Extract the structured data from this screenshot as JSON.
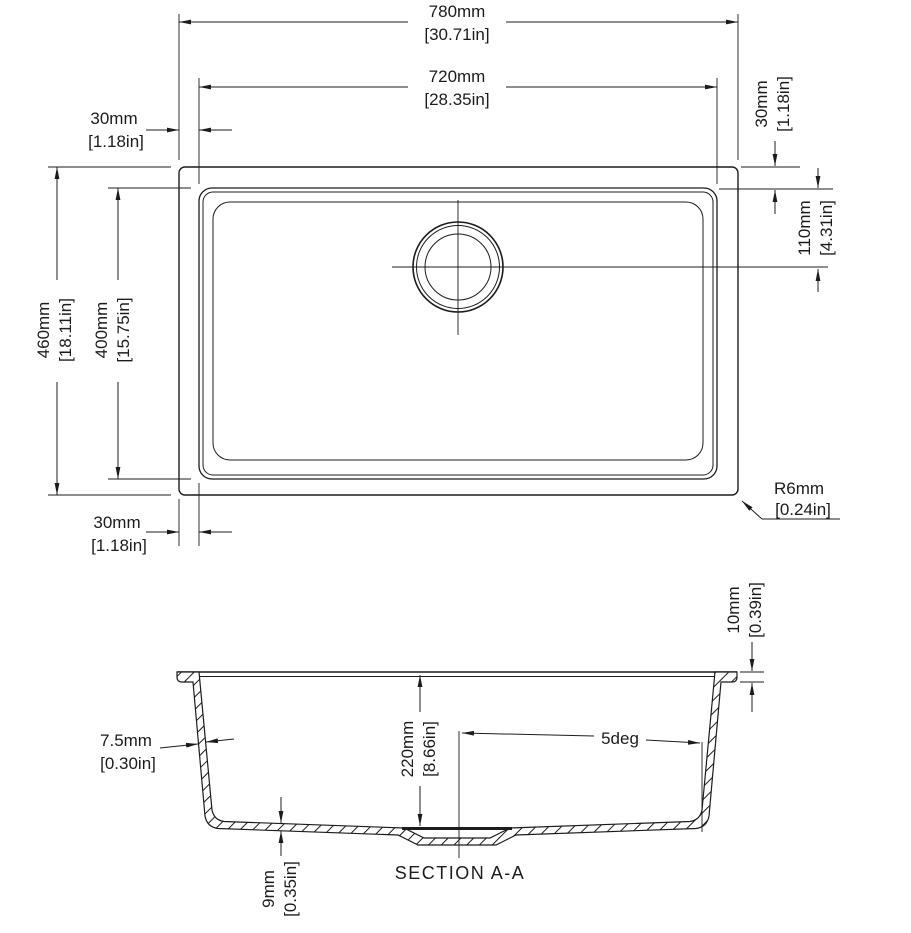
{
  "top_view": {
    "overall_width": {
      "mm": "780mm",
      "in": "[30.71in]"
    },
    "inner_width": {
      "mm": "720mm",
      "in": "[28.35in]"
    },
    "left_offset_top": {
      "mm": "30mm",
      "in": "[1.18in]"
    },
    "right_offset": {
      "mm": "30mm",
      "in": "[1.18in]"
    },
    "drain_offset": {
      "mm": "110mm",
      "in": "[4.31in]"
    },
    "overall_height": {
      "mm": "460mm",
      "in": "[18.11in]"
    },
    "inner_height": {
      "mm": "400mm",
      "in": "[15.75in]"
    },
    "left_offset_bottom": {
      "mm": "30mm",
      "in": "[1.18in]"
    },
    "corner_radius": {
      "mm": "R6mm",
      "in": "[0.24in]"
    }
  },
  "section_view": {
    "label": "SECTION A-A",
    "rim_height": {
      "mm": "10mm",
      "in": "[0.39in]"
    },
    "wall_thickness": {
      "mm": "7.5mm",
      "in": "[0.30in]"
    },
    "bowl_depth": {
      "mm": "220mm",
      "in": "[8.66in]"
    },
    "wall_angle": "5deg",
    "bottom_thickness": {
      "mm": "9mm",
      "in": "[0.35in]"
    }
  },
  "colors": {
    "line": "#1c1c1c",
    "background": "#ffffff"
  }
}
